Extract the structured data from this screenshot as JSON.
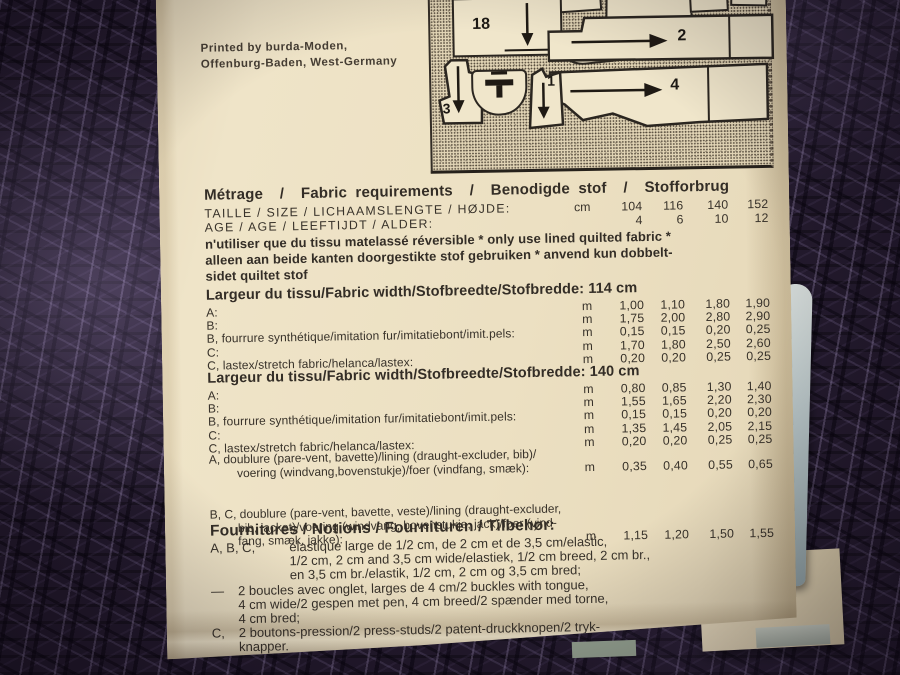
{
  "credit": {
    "line1": "Printed by burda-Moden,",
    "line2": "Offenburg-Baden, West-Germany"
  },
  "diagram": {
    "pieces": [
      {
        "label": "18",
        "arrow": "down"
      },
      {
        "label": "19",
        "arrow": "down"
      },
      {
        "label": "11",
        "arrow": "none"
      },
      {
        "label": "15",
        "arrow": "none"
      },
      {
        "label": "10",
        "arrow": "down"
      },
      {
        "label": "9",
        "arrow": "none"
      },
      {
        "label": "2",
        "arrow": "right"
      },
      {
        "label": "4",
        "arrow": "right"
      },
      {
        "label": "3",
        "arrow": "down"
      },
      {
        "label": "1",
        "arrow": "down"
      }
    ]
  },
  "metrage": {
    "heading": "Métrage  /  Fabric requirements  /  Benodigde stof  /  Stofforbrug",
    "size_row": {
      "label": "TAILLE / SIZE / LICHAAMSLENGTE / HØJDE:",
      "unit": "cm",
      "values": [
        "104",
        "116",
        "140",
        "152"
      ]
    },
    "age_row": {
      "label": "AGE / AGE / LEEFTIJDT / ALDER:",
      "unit": "",
      "values": [
        "4",
        "6",
        "10",
        "12"
      ]
    },
    "notice_lines": [
      "n'utiliser que du tissu matelassé réversible * only use lined quilted fabric *",
      "alleen aan beide kanten doorgestikte stof gebruiken * anvend kun dobbelt-",
      "sidet quiltet stof"
    ]
  },
  "width114": {
    "heading": "Largeur du tissu/Fabric width/Stofbreedte/Stofbredde: 114 cm",
    "rows": [
      {
        "label": "A:",
        "unit": "m",
        "values": [
          "1,00",
          "1,10",
          "1,80",
          "1,90"
        ]
      },
      {
        "label": "B:",
        "unit": "m",
        "values": [
          "1,75",
          "2,00",
          "2,80",
          "2,90"
        ]
      },
      {
        "label": "B, fourrure synthétique/imitation fur/imitatiebont/imit.pels:",
        "unit": "m",
        "values": [
          "0,15",
          "0,15",
          "0,20",
          "0,25"
        ]
      },
      {
        "label": "C:",
        "unit": "m",
        "values": [
          "1,70",
          "1,80",
          "2,50",
          "2,60"
        ]
      },
      {
        "label": "C, lastex/stretch fabric/helanca/lastex:",
        "unit": "m",
        "values": [
          "0,20",
          "0,20",
          "0,25",
          "0,25"
        ]
      }
    ]
  },
  "width140": {
    "heading": "Largeur du tissu/Fabric width/Stofbreedte/Stofbredde: 140 cm",
    "rows": [
      {
        "label": "A:",
        "unit": "m",
        "values": [
          "0,80",
          "0,85",
          "1,30",
          "1,40"
        ]
      },
      {
        "label": "B:",
        "unit": "m",
        "values": [
          "1,55",
          "1,65",
          "2,20",
          "2,30"
        ]
      },
      {
        "label": "B, fourrure synthétique/imitation fur/imitatiebont/imit.pels:",
        "unit": "m",
        "values": [
          "0,15",
          "0,15",
          "0,20",
          "0,20"
        ]
      },
      {
        "label": "C:",
        "unit": "m",
        "values": [
          "1,35",
          "1,45",
          "2,05",
          "2,15"
        ]
      },
      {
        "label": "C, lastex/stretch fabric/helanca/lastex:",
        "unit": "m",
        "values": [
          "0,20",
          "0,20",
          "0,25",
          "0,25"
        ]
      }
    ]
  },
  "lining": {
    "rows": [
      {
        "lines": [
          "A, doublure (pare-vent, bavette)/lining (draught-excluder, bib)/",
          "voering (windvang,bovenstukje)/foer (vindfang, smæk):"
        ],
        "unit": "m",
        "values": [
          "0,35",
          "0,40",
          "0,55",
          "0,65"
        ]
      },
      {
        "lines": [
          "B, C, doublure (pare-vent, bavette, veste)/lining (draught-excluder,",
          "bib, jacket)/voering (windvang, bovenstukje, jack)/foer (vind-",
          "fang, smæk, jakke):"
        ],
        "unit": "m",
        "values": [
          "1,15",
          "1,20",
          "1,50",
          "1,55"
        ]
      }
    ]
  },
  "notions": {
    "heading": "Fournitures / Notions / Fournituren / Tilbehør:",
    "item1": {
      "prefix": "A, B, C,",
      "lines": [
        "élastique large de 1/2 cm, de 2 cm et de 3,5 cm/elastic,",
        "1/2 cm, 2 cm and 3,5 cm wide/elastiek, 1/2 cm breed, 2 cm br.,",
        "en 3,5 cm br./elastik, 1/2 cm, 2 cm og 3,5 cm bred;"
      ]
    },
    "item2": {
      "prefix": "—",
      "lines": [
        "2 boucles avec onglet, larges de 4 cm/2 buckles with tongue,",
        "4 cm wide/2 gespen met pen, 4 cm breed/2 spænder med torne,",
        "4 cm bred;"
      ]
    },
    "item3": {
      "prefix": "C,",
      "lines": [
        "2 boutons-pression/2 press-studs/2 patent-druckknopen/2 tryk-",
        "knapper."
      ]
    }
  },
  "colors": {
    "paper": "#ece0c2",
    "ink": "#38322a",
    "fabric": "#241a2c",
    "strip": "#b4c0c0"
  }
}
